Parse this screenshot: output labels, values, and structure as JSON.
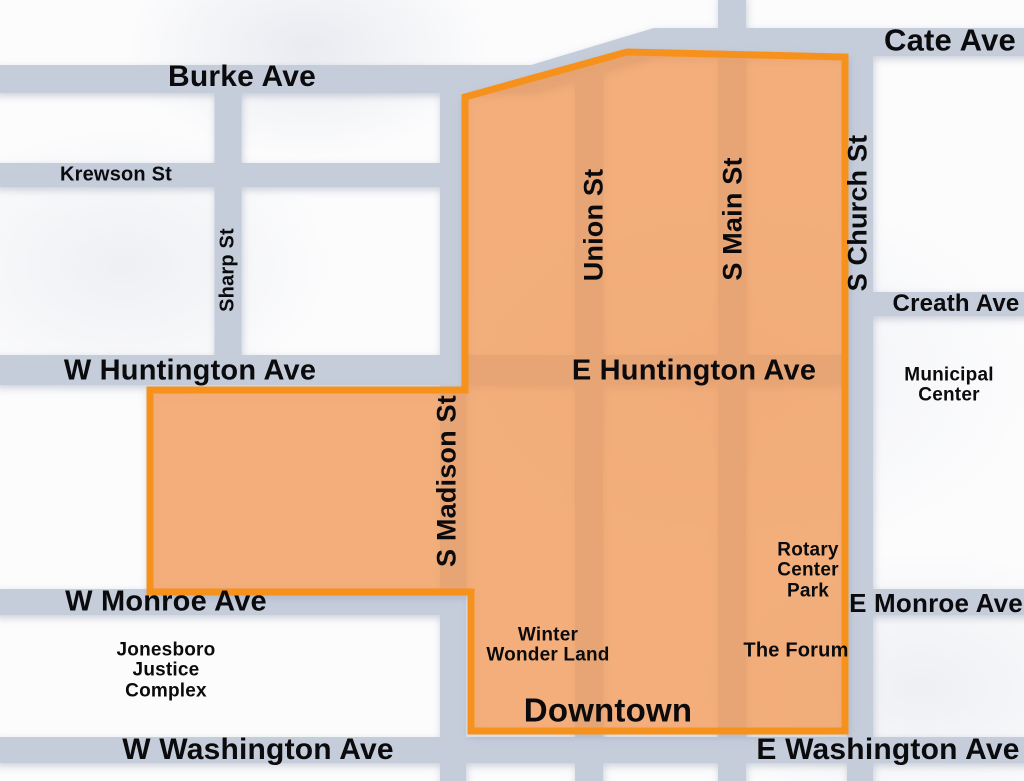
{
  "map": {
    "area_label": "Downtown",
    "streets": {
      "cate": "Cate Ave",
      "burke": "Burke Ave",
      "krewson": "Krewson St",
      "sharp": "Sharp St",
      "union": "Union St",
      "s_main": "S Main St",
      "s_church": "S Church St",
      "creath": "Creath Ave",
      "w_huntington": "W Huntington Ave",
      "e_huntington": "E Huntington Ave",
      "s_madison": "S Madison St",
      "w_monroe": "W Monroe Ave",
      "e_monroe": "E Monroe Ave",
      "w_washington": "W Washington Ave",
      "e_washington": "E Washington Ave"
    },
    "places": {
      "municipal_center": "Municipal\nCenter",
      "rotary_center_park": "Rotary\nCenter\nPark",
      "jonesboro_justice_complex": "Jonesboro\nJustice\nComplex",
      "winter_wonder_land": "Winter\nWonder Land",
      "the_forum": "The Forum"
    },
    "colors": {
      "street": "#C5CDDB",
      "street_under_highlight": "#E9A872",
      "highlight_fill": "rgba(248,153,71,0.71)",
      "highlight_border": "#F6921E",
      "label_text": "#0B0B0D",
      "background": "#FCFCFD"
    }
  }
}
